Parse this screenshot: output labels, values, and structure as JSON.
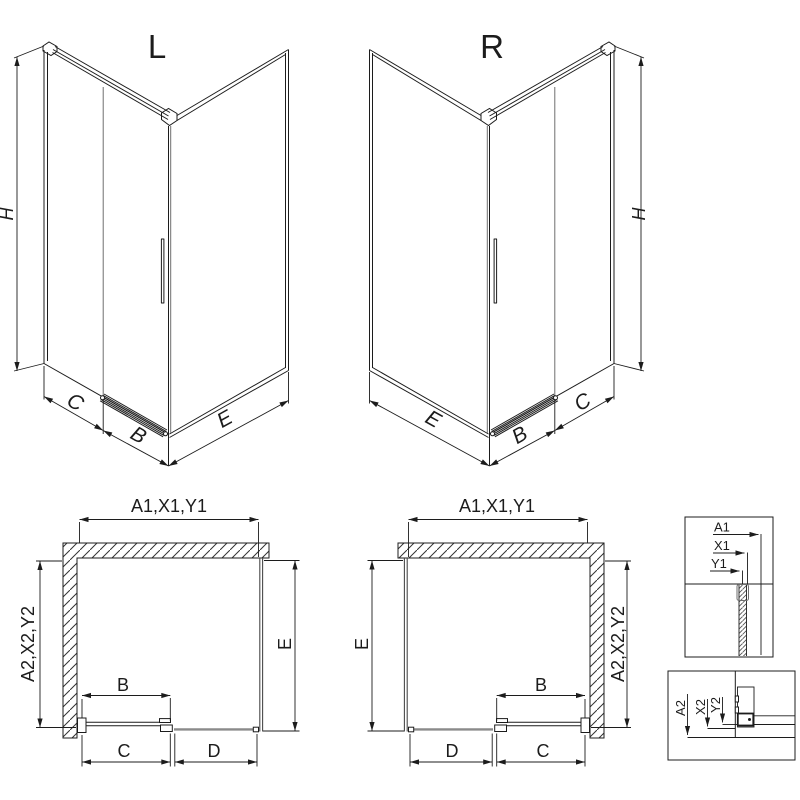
{
  "diagram": {
    "iso_left": {
      "title": "L",
      "height_label": "H",
      "fixed_label": "C",
      "door_label": "B",
      "side_label": "E"
    },
    "iso_right": {
      "title": "R",
      "height_label": "H",
      "fixed_label": "C",
      "door_label": "B",
      "side_label": "E"
    },
    "plan_left": {
      "width_label": "A1,X1,Y1",
      "depth_left_label": "A2,X2,Y2",
      "depth_right_label": "E",
      "door_label": "B",
      "fixed_bottom_label": "C",
      "inline_label": "D"
    },
    "plan_right": {
      "width_label": "A1,X1,Y1",
      "depth_left_label": "E",
      "depth_right_label": "A2,X2,Y2",
      "door_label": "B",
      "inline_label": "D",
      "fixed_bottom_label": "C"
    },
    "detail_top": {
      "labels": [
        "A1",
        "X1",
        "Y1"
      ]
    },
    "detail_bottom": {
      "labels": [
        "A2",
        "X2",
        "Y2"
      ]
    },
    "colors": {
      "line": "#1c1c1c",
      "glass_gray": "#8a8a8a",
      "hatch": "#333333"
    }
  }
}
